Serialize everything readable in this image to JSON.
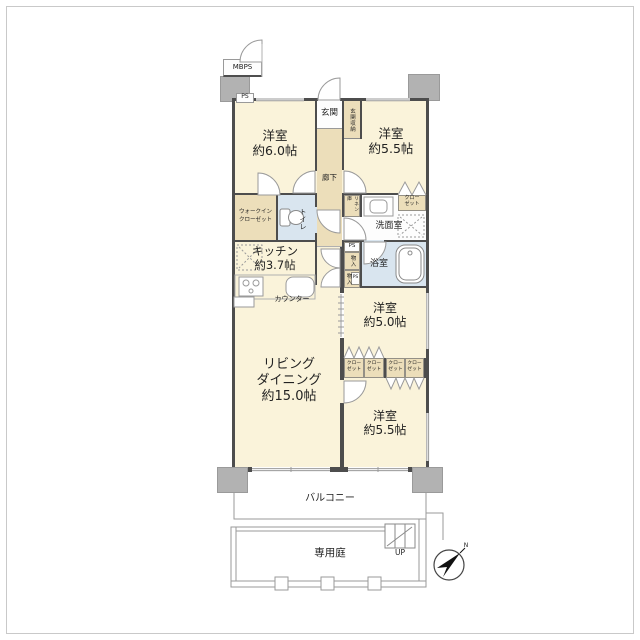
{
  "colors": {
    "room_cream": "#faf3da",
    "service_beige": "#ecdeba",
    "wet_blue": "#d9e5ef",
    "wall_dark": "#4d4d4d",
    "shaft_gray": "#b2b2b2"
  },
  "shafts": {
    "mbps": "MBPS",
    "ps": "PS"
  },
  "entrance": {
    "label": "玄関",
    "storage": "玄関収納"
  },
  "corridor": {
    "label": "廊下"
  },
  "rooms": {
    "bedroom_nw": {
      "name": "洋室",
      "size": "約6.0帖"
    },
    "bedroom_ne": {
      "name": "洋室",
      "size": "約5.5帖"
    },
    "bedroom_e": {
      "name": "洋室",
      "size": "約5.0帖"
    },
    "bedroom_se": {
      "name": "洋室",
      "size": "約5.5帖"
    },
    "kitchen": {
      "name": "キッチン",
      "size": "約3.7帖"
    },
    "living_dining": {
      "line1": "リビング",
      "line2": "ダイニング",
      "size": "約15.0帖"
    }
  },
  "storage": {
    "wic_line1": "ウォークイン",
    "wic_line2": "クローゼット",
    "closet_line1": "クロー",
    "closet_line2": "ゼット",
    "linen": "リネン庫",
    "mono": "物入"
  },
  "wet": {
    "toilet": "トイレ",
    "washroom": "洗面室",
    "bathroom": "浴室"
  },
  "kitchen_fixtures": {
    "counter": "カウンター"
  },
  "outdoor": {
    "balcony": "バルコニー",
    "garden": "専用庭",
    "up": "UP",
    "north": "N"
  }
}
